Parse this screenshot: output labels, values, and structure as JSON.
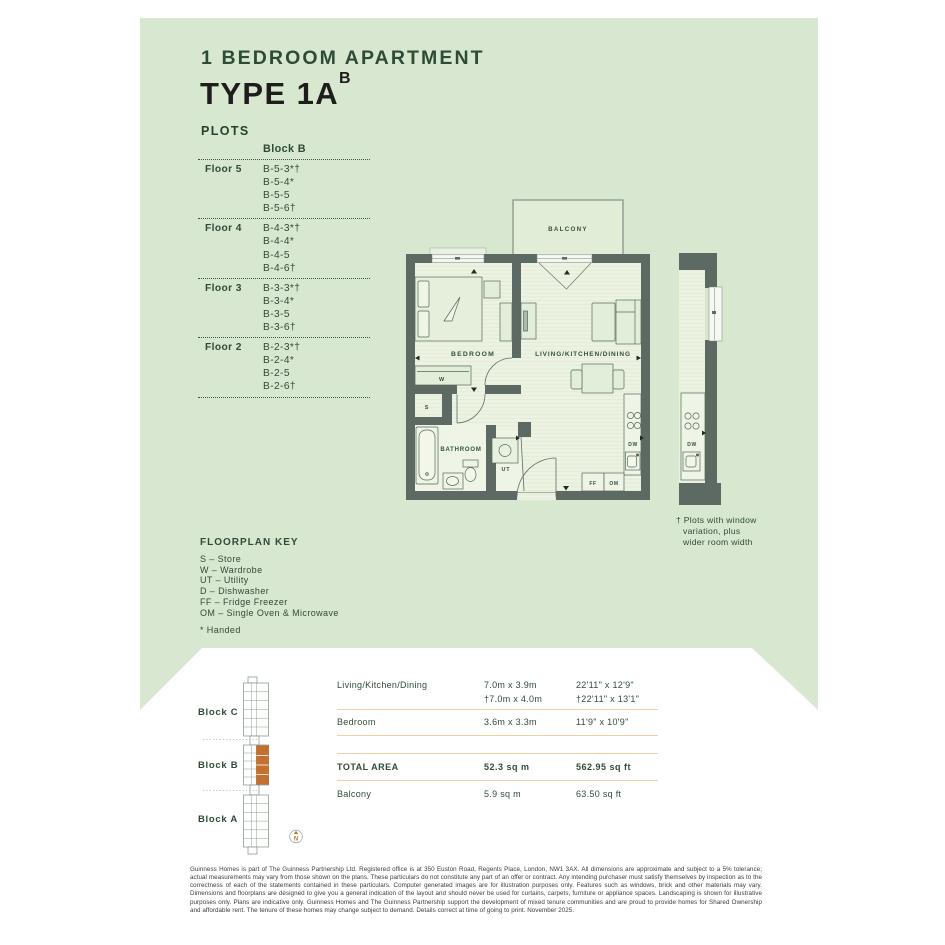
{
  "header": {
    "subtitle": "1 BEDROOM APARTMENT",
    "title": "TYPE 1A",
    "title_superscript": "B"
  },
  "plots": {
    "heading": "PLOTS",
    "block_header": "Block B",
    "floors": [
      {
        "label": "Floor 5",
        "plots": [
          "B-5-3*†",
          "B-5-4*",
          "B-5-5",
          "B-5-6†"
        ]
      },
      {
        "label": "Floor 4",
        "plots": [
          "B-4-3*†",
          "B-4-4*",
          "B-4-5",
          "B-4-6†"
        ]
      },
      {
        "label": "Floor 3",
        "plots": [
          "B-3-3*†",
          "B-3-4*",
          "B-3-5",
          "B-3-6†"
        ]
      },
      {
        "label": "Floor 2",
        "plots": [
          "B-2-3*†",
          "B-2-4*",
          "B-2-5",
          "B-2-6†"
        ]
      }
    ]
  },
  "floorplan": {
    "labels": {
      "balcony": "BALCONY",
      "bedroom": "BEDROOM",
      "living": "LIVING/KITCHEN/DINING",
      "bathroom": "BATHROOM",
      "wardrobe": "W",
      "store": "S",
      "utility": "UT",
      "dishwasher": "DW",
      "fridge_freezer": "FF",
      "oven_microwave": "OM",
      "dishwasher_variant": "DW"
    },
    "note_lines": [
      "† Plots with window",
      "variation, plus",
      "wider room width"
    ]
  },
  "key": {
    "heading": "FLOORPLAN KEY",
    "items": [
      "S – Store",
      "W – Wardrobe",
      "UT – Utility",
      "D – Dishwasher",
      "FF – Fridge Freezer",
      "OM – Single Oven & Microwave"
    ],
    "handed": "* Handed"
  },
  "siteplan": {
    "block_labels": [
      "Block C",
      "Block B",
      "Block A"
    ],
    "compass": "N"
  },
  "dimensions": {
    "rows": [
      {
        "label": "Living/Kitchen/Dining",
        "metric": "7.0m x 3.9m",
        "metric2": "†7.0m x 4.0m",
        "imperial": "22'11\" x 12'9\"",
        "imperial2": "†22'11\" x 13'1\""
      },
      {
        "label": "Bedroom",
        "metric": "3.6m x 3.3m",
        "metric2": "",
        "imperial": "11'9\" x 10'9\"",
        "imperial2": ""
      }
    ],
    "total": {
      "label": "TOTAL AREA",
      "metric": "52.3 sq m",
      "imperial": "562.95 sq ft"
    },
    "balcony": {
      "label": "Balcony",
      "metric": "5.9 sq m",
      "imperial": "63.50 sq ft"
    }
  },
  "footer": {
    "legal": "Guinness Homes is part of The Guinness Partnership Ltd. Registered office is at 350 Euston Road, Regents Place, London, NW1 3AX. All dimensions are approximate and subject to a 5% tolerance; actual measurements may vary from those shown on the plans. These particulars do not constitute any part of an offer or contract. Any intending purchaser must satisfy themselves by inspection as to the correctness of each of the statements contained in these particulars. Computer generated images are for illustration purposes only. Features such as windows, brick and other materials may vary. Dimensions and floorplans are designed to give you a general indication of the layout and should never be used for curtains, carpets, furniture or appliance spaces. Landscaping is shown for illustrative purposes only. Plans are indicative only. Guinness Homes and The Guinness Partnership support the development of mixed tenure communities and are proud to provide homes for Shared Ownership and affordable rent. The tenure of these homes may change subject to demand. Details correct at time of going to print. November 2025."
  },
  "colors": {
    "background_green": "#d8e7d0",
    "dark_green": "#2e4b38",
    "wall_gray": "#5d6963",
    "accent_orange": "#c4702e",
    "table_line_peach": "#f3cfa8"
  }
}
